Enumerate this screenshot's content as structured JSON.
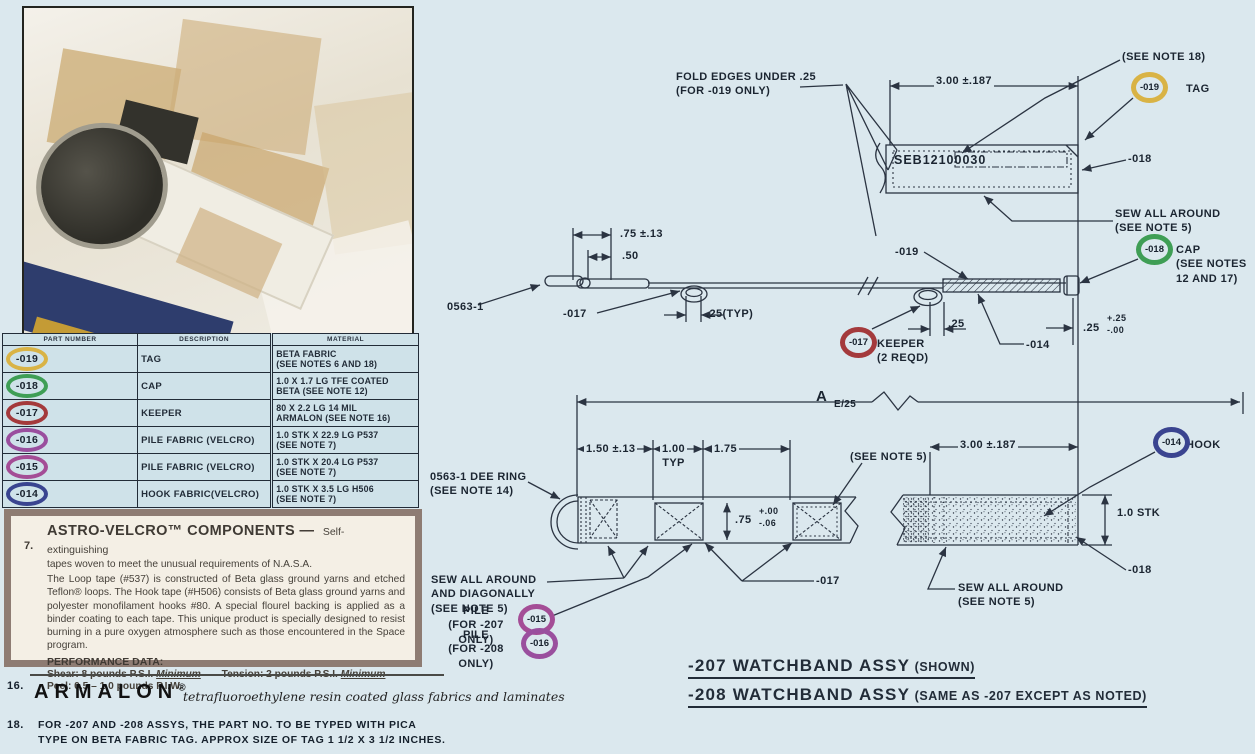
{
  "colors": {
    "page_bg": "#dbe8ee",
    "ink": "#222c38",
    "table_bg": "#cfe2e9",
    "note_box_bg": "#f4efe5",
    "note_box_border": "#8e7c73",
    "ring_019": "#d9b345",
    "ring_018": "#3f9e55",
    "ring_017": "#a43a3c",
    "ring_016": "#9a4f9e",
    "ring_015": "#a44d96",
    "ring_014": "#3a4490"
  },
  "parts_table": {
    "headers": [
      "PART NUMBER",
      "DESCRIPTION",
      "MATERIAL"
    ],
    "rows": [
      {
        "part": "-019",
        "ring_style": "border-color:#d9b345",
        "description": "TAG",
        "material": "BETA FABRIC\n(SEE NOTES 6 AND 18)"
      },
      {
        "part": "-018",
        "ring_style": "border-color:#3f9e55",
        "description": "CAP",
        "material": "1.0 X 1.7 LG  TFE COATED\nBETA (SEE NOTE 12)"
      },
      {
        "part": "-017",
        "ring_style": "border-color:#a43a3c",
        "description": "KEEPER",
        "material": "80 X 2.2 LG  14 MIL\nARMALON (SEE NOTE 16)"
      },
      {
        "part": "-016",
        "ring_style": "border-color:#9a4f9e",
        "description": "PILE FABRIC (VELCRO)",
        "material": "1.0 STK X 22.9 LG P537\n(SEE NOTE 7)"
      },
      {
        "part": "-015",
        "ring_style": "border-color:#a44d96",
        "description": "PILE FABRIC (VELCRO)",
        "material": "1.0 STK X 20.4 LG P537\n(SEE NOTE 7)"
      },
      {
        "part": "-014",
        "ring_style": "border-color:#3a4490",
        "description": "HOOK FABRIC(VELCRO)",
        "material": "1.0 STK X 3.5 LG H506\n(SEE NOTE 7)"
      }
    ]
  },
  "velcro_note": {
    "number": "7.",
    "title": "ASTRO-VELCRO™ COMPONENTS —",
    "title_suffix": "Self-extinguishing",
    "intro": "tapes woven to meet the unusual requirements of N.A.S.A.",
    "body": "The Loop tape (#537) is constructed of Beta glass ground yarns and etched Teflon® loops. The Hook tape (#H506) consists of Beta glass ground yarns and polyester monofilament hooks #80. A special flourel backing is applied as a binder coating to each tape. This unique product is specially designed to resist burning in a pure oxygen atmosphere such as those encountered in the Space program.",
    "performance_heading": "PERFORMANCE DATA:",
    "shear": "Shear: 8 pounds P.S.I.",
    "shear_min": "Minimum",
    "tension": "Tension: 2 pounds P.S.I.",
    "tension_min": "Minimum",
    "peel": "Peel: 0.5 – 1.0 pounds P.I.W."
  },
  "armalon_note": {
    "number": "16.",
    "brand": "ARMALON",
    "reg": "®",
    "descriptor": "tetrafluoroethylene resin coated glass fabrics and laminates"
  },
  "note18": {
    "number": "18.",
    "text": "FOR -207 AND -208 ASSYS, THE PART NO. TO BE TYPED WITH PICA\nTYPE ON BETA FABRIC TAG. APPROX SIZE OF TAG  1 1/2 X 3 1/2 INCHES."
  },
  "drawing": {
    "labels": {
      "fold_note": "FOLD EDGES UNDER .25\n(FOR -019 ONLY)",
      "dim300_tag": "3.00 ±.187",
      "note18_ref": "(SEE NOTE 18)",
      "tag_label": "TAG",
      "tag_text": "SEB12100030",
      "callout_018_tag": "-018",
      "sew_note_tag": "SEW ALL AROUND\n(SEE NOTE 5)",
      "dim_75": ".75 ±.13",
      "dim_50": ".50",
      "dee_ref": "0563-1",
      "callout_017_side": "-017",
      "dim_25typ": ".25(TYP)",
      "callout_019_side": "-019",
      "cap_note": "CAP\n(SEE NOTES\n12 AND 17)",
      "keeper_note": "KEEPER\n(2 REQD)",
      "dim_25_keeper": ".25",
      "callout_014_side": "-014",
      "dim25tol_base": ".25",
      "dim25tol_plus": "+.25",
      "dim25tol_minus": "-.00",
      "dim_a": "A",
      "dim_a_sub": "E/25",
      "dim_150": "1.50 ±.13",
      "dim_100": "1.00\nTYP",
      "dim_175": "1.75",
      "dee_note": "0563-1 DEE RING\n(SEE NOTE 14)",
      "note5_ref": "(SEE NOTE 5)",
      "dim300_band": "3.00 ±.187",
      "hook_label": "HOOK",
      "dim75b_base": ".75",
      "dim75b_plus": "+.00",
      "dim75b_minus": "-.06",
      "stk": "1.0 STK",
      "sew_diag": "SEW ALL AROUND\nAND DIAGONALLY\n(SEE NOTE 5)",
      "pile207": "PILE\n(FOR -207 ONLY)",
      "pile208": "PILE\n(FOR -208 ONLY)",
      "callout_017_asm": "-017",
      "sew_note_asm": "SEW ALL AROUND\n(SEE NOTE 5)",
      "callout_018_asm": "-018"
    },
    "balloons": {
      "b019": {
        "label": "-019",
        "ring_style": "border-color:#d9b345"
      },
      "b018": {
        "label": "-018",
        "ring_style": "border-color:#3f9e55"
      },
      "b017": {
        "label": "-017",
        "ring_style": "border-color:#a43a3c"
      },
      "b015": {
        "label": "-015",
        "ring_style": "border-color:#a44d96"
      },
      "b016": {
        "label": "-016",
        "ring_style": "border-color:#9a4f9e"
      },
      "b014": {
        "label": "-014",
        "ring_style": "border-color:#3a4490"
      }
    },
    "titles": {
      "t207": "-207 WATCHBAND ASSY",
      "t207_suffix": "(SHOWN)",
      "t208": "-208 WATCHBAND ASSY",
      "t208_suffix": "(SAME AS -207 EXCEPT AS NOTED)"
    }
  }
}
